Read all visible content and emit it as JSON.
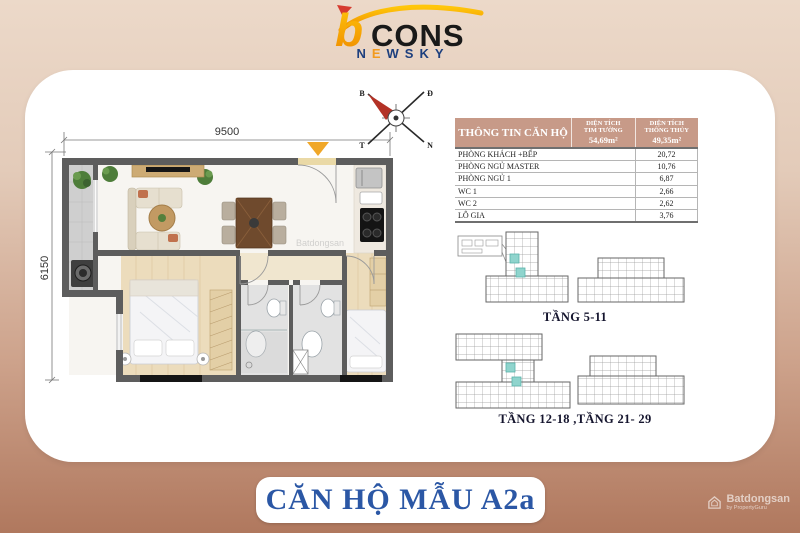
{
  "logo": {
    "b": "b",
    "cons": "CONS",
    "newsky_letters": [
      "N",
      "E",
      "W",
      "S",
      "K",
      "Y"
    ]
  },
  "floor_plan": {
    "dim_width": "9500",
    "dim_height": "6150",
    "compass": {
      "nw": "B",
      "ne": "Đ",
      "sw": "T",
      "se": "N"
    },
    "watermark": "Batdongsan"
  },
  "info_table": {
    "title": "THÔNG TIN CĂN HỘ",
    "col_tim_tuong": {
      "line1": "DIỆN TÍCH",
      "line2": "TIM TƯỜNG",
      "value": "54,69m²"
    },
    "col_thong_thuy": {
      "line1": "DIỆN TÍCH",
      "line2": "THÔNG THỦY",
      "value": "49,35m²"
    },
    "rows": [
      {
        "name": "PHÒNG KHÁCH +BẾP",
        "value": "20,72"
      },
      {
        "name": "PHÒNG NGỦ MASTER",
        "value": "10,76"
      },
      {
        "name": "PHÒNG NGỦ 1",
        "value": "6,87"
      },
      {
        "name": "WC 1",
        "value": "2,66"
      },
      {
        "name": "WC 2",
        "value": "2,62"
      },
      {
        "name": "LÔ GIA",
        "value": "3,76"
      }
    ]
  },
  "floor_diagrams": {
    "label_1": "TẦNG 5-11",
    "label_2": "TẦNG 12-18 ,TẦNG 21- 29"
  },
  "banner": {
    "text": "CĂN HỘ MẪU A2a"
  },
  "page_watermark": {
    "brand": "Batdongsan",
    "sub": "by PropertyGuru"
  },
  "colors": {
    "accent_gold": "#f0a728",
    "brand_navy": "#1d3f7e",
    "brand_orange": "#f29a1d",
    "banner_blue": "#2b57a5",
    "table_header_bg": "#c79a88",
    "highlight_teal": "#8fd4cd",
    "bg_top": "#ecd9c9",
    "bg_bottom": "#b0785e",
    "wall_gray": "#5d5d5d"
  }
}
